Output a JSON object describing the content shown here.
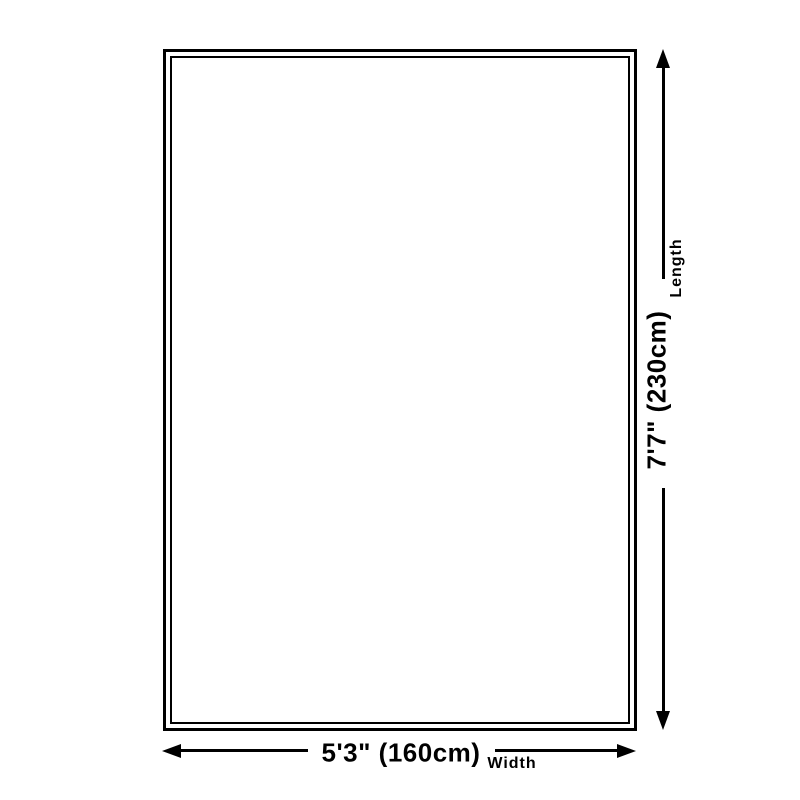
{
  "diagram": {
    "background_color": "#ffffff",
    "line_color": "#000000",
    "rug": {
      "outer_border_color": "#000000",
      "inner_border_color": "#000000"
    },
    "length": {
      "value": "7'7\" (230cm)",
      "label": "Length"
    },
    "width": {
      "value": "5'3\" (160cm)",
      "label": "Width"
    }
  }
}
